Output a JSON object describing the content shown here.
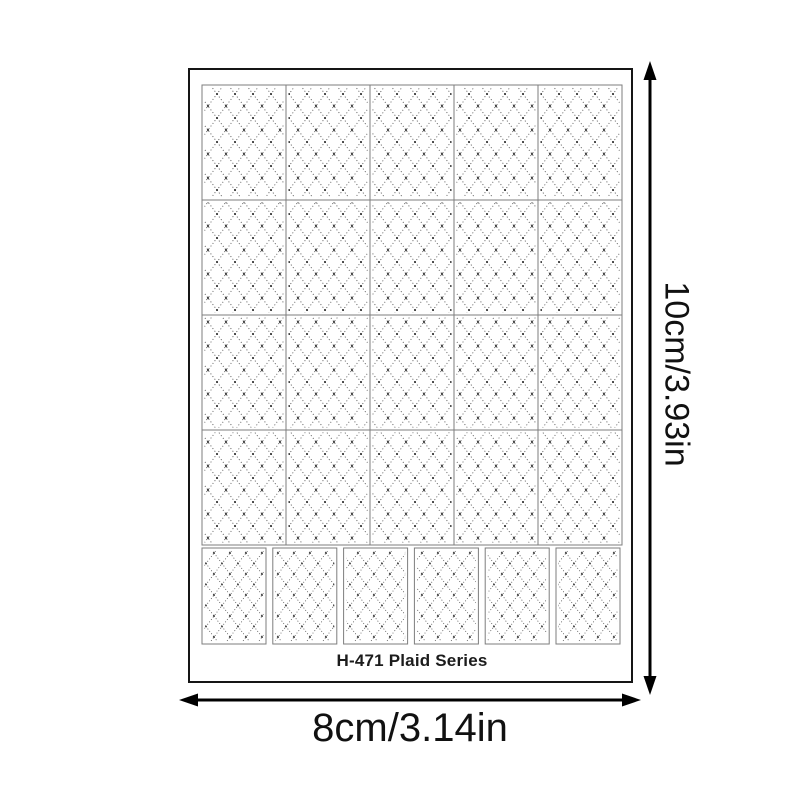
{
  "image": {
    "type": "product-dimension-diagram",
    "background": "#ffffff"
  },
  "sheet": {
    "label": "H-471 Plaid Series",
    "pattern_name": "dotted-diamond-plaid",
    "grid": {
      "rows": 4,
      "cols": 5,
      "small_row_cols": 6
    }
  },
  "dimensions": {
    "height_label": "10cm/3.93in",
    "width_label": "8cm/3.14in"
  },
  "colors": {
    "sheet_border": "#151515",
    "grid_line": "#7d7d7d",
    "pattern_dot": "#4d4d4d",
    "pattern_node": "#2e2e2e",
    "arrow": "#000000",
    "text": "#111111"
  }
}
